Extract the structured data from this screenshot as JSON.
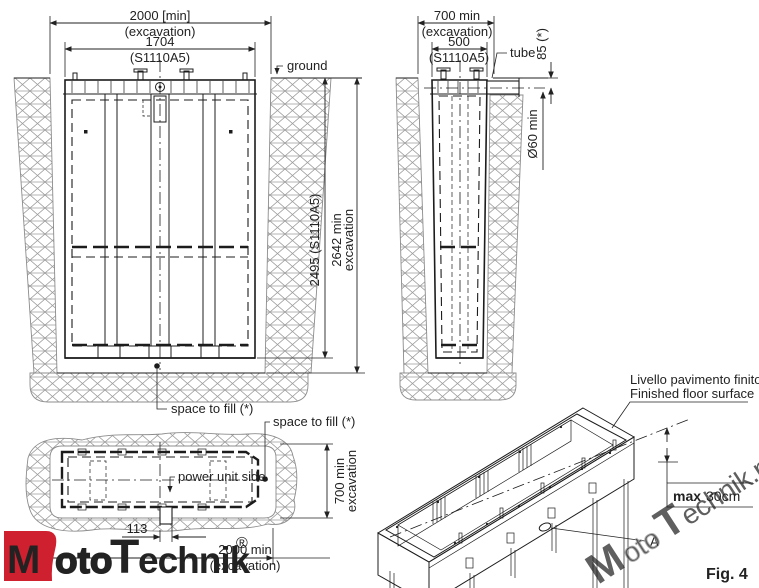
{
  "front_view": {
    "excavation_width": "2000  [min]",
    "excavation_width_note": "(excavation)",
    "frame_width": "1704",
    "frame_width_note": "(S1110A5)",
    "ground_label": "ground",
    "frame_depth": "2495  (S1110A5)",
    "excavation_depth": "2642  min",
    "excavation_depth_note": "excavation",
    "space_to_fill_label": "space to fill (*)"
  },
  "side_view": {
    "excavation_width": "700  min",
    "excavation_width_note": "(excavation)",
    "frame_width": "500",
    "frame_width_note": "(S1110A5)",
    "tube_label": "tube",
    "tube_depth": "85  (*)",
    "tube_diameter": "Ø60 min"
  },
  "plan_view": {
    "space_to_fill_label": "space to fill (*)",
    "power_unit_label": "power unit side",
    "excavation_width": "700  min",
    "excavation_width_note": "excavation",
    "pipe_offset": "113",
    "excavation_length": "2000  min",
    "excavation_length_note": "(excavation)"
  },
  "iso_view": {
    "floor_level_line1": "Livello pavimento finito",
    "floor_level_line2": "Finished floor surface",
    "max_label": "max",
    "max_value": "30cm",
    "detail_label": "A",
    "figure_label": "Fig. 4"
  },
  "branding": {
    "logo_m": "M",
    "logo_oto": "oto",
    "logo_t": "T",
    "logo_echnik": "echnik",
    "logo_reg": "®",
    "watermark_m": "M",
    "watermark_oto": "oto",
    "watermark_t": "T",
    "watermark_rest": "echnik.pl"
  },
  "colors": {
    "line": "#222222",
    "hatch": "#9b9b9b",
    "logo_red": "#cf2030",
    "watermark_gray": "#7d7d7d",
    "watermark_red": "#cf4a4a"
  }
}
